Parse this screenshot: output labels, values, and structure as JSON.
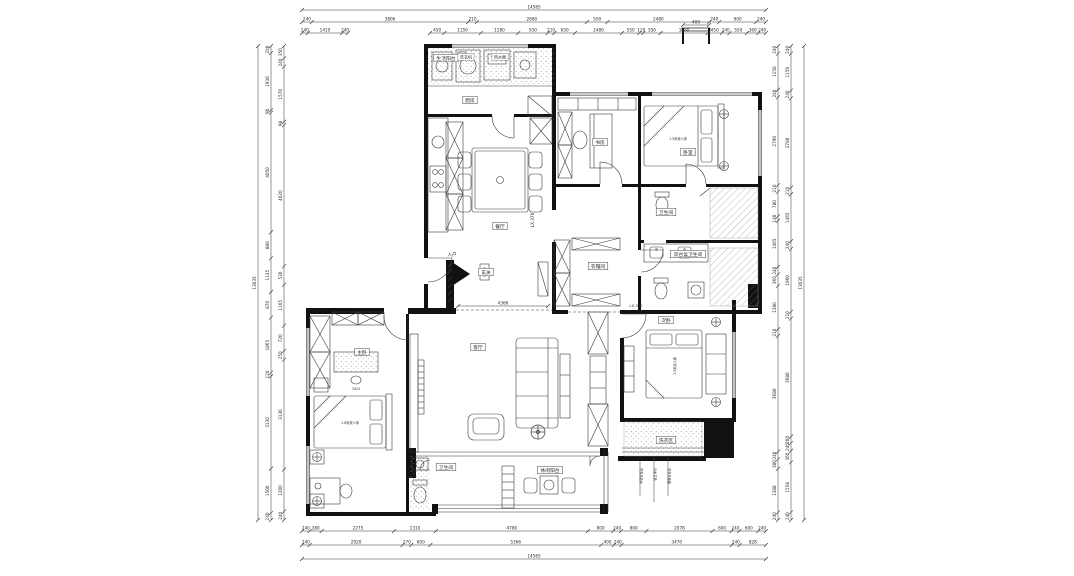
{
  "meta": {
    "drawing_type": "residential floor plan (CAD)",
    "units": "mm"
  },
  "colors": {
    "line": "#3a3a3a",
    "wall": "#111111",
    "dim": "#333333",
    "bg": "#ffffff"
  },
  "dimensions": {
    "top": {
      "total": [
        "14565"
      ],
      "row2": [
        "240",
        "3806",
        "210",
        "2680",
        "500",
        "2480",
        "240",
        "900",
        "240"
      ],
      "row3_left": [
        "240",
        "1410",
        "240"
      ],
      "row3_right": [
        "450",
        "1150",
        "1180",
        "930",
        "210",
        "650",
        "1480",
        "550",
        "120",
        "550",
        "1480",
        "450",
        "240",
        "550",
        "360",
        "240"
      ]
    },
    "bottom": {
      "row1": [
        "240",
        "380",
        "2275",
        "1310",
        "4780",
        "800",
        "240",
        "800",
        "2078",
        "600",
        "240",
        "600",
        "240"
      ],
      "row2": [
        "240",
        "2920",
        "270",
        "600",
        "5366",
        "400",
        "240",
        "3470",
        "240",
        "828"
      ],
      "total": [
        "14565"
      ]
    },
    "left": {
      "total": [
        "13035"
      ],
      "col_outer": [
        "240",
        "1930",
        "90",
        "4050",
        "880",
        "1145",
        "870",
        "1865",
        "120",
        "3130",
        "1500",
        "240"
      ],
      "col_inner": [
        "350",
        "240",
        "1570",
        "98",
        "4020",
        "530",
        "1165",
        "720",
        "250",
        "3130",
        "1200",
        "240"
      ]
    },
    "right": {
      "total": [
        "13035"
      ],
      "col_inner": [
        "240",
        "1150",
        "240",
        "2790",
        "210",
        "780",
        "140",
        "1465",
        "240",
        "360",
        "1380",
        "210",
        "3680",
        "240",
        "300",
        "1388",
        "240"
      ],
      "col_outer": [
        "240",
        "1150",
        "240",
        "2780",
        "210",
        "1465",
        "240",
        "1960",
        "210",
        "3680",
        "200",
        "240",
        "360",
        "1558",
        "240"
      ]
    },
    "flue": [
      "400"
    ],
    "hall_inline": [
      "4366"
    ]
  },
  "rooms": [
    {
      "id": "balcony_service",
      "label": "生活阳台"
    },
    {
      "id": "kitchen",
      "label": "厨房"
    },
    {
      "id": "dining",
      "label": "餐厅"
    },
    {
      "id": "study",
      "label": "书房"
    },
    {
      "id": "bedroom2",
      "label": "卧室"
    },
    {
      "id": "bath1",
      "label": "卫生间"
    },
    {
      "id": "bath2",
      "label": "双台盆卫生间"
    },
    {
      "id": "cloakroom",
      "label": "衣帽间"
    },
    {
      "id": "entry",
      "label": "玄关"
    },
    {
      "id": "living",
      "label": "客厅"
    },
    {
      "id": "master",
      "label": "主卧"
    },
    {
      "id": "bedroom3",
      "label": "次卧"
    },
    {
      "id": "wc",
      "label": "卫生间"
    },
    {
      "id": "balcony_leisure",
      "label": "休闲阳台"
    },
    {
      "id": "laundry",
      "label": "洗衣区"
    }
  ],
  "annotations": {
    "level_living": "LX.370",
    "level_bedroom": "LX.300",
    "entry_arrow": "入户",
    "bed_master": "1.8米双人床",
    "bed_guest": "1.5米双人床",
    "bed_second": "1.5米双人床",
    "dresser_dim": "3424"
  },
  "appliance_labels": [
    "洗衣机",
    "热水器"
  ],
  "laundry_notes": [
    "洗衣机给水",
    "污水立管",
    "洗衣机地漏"
  ]
}
